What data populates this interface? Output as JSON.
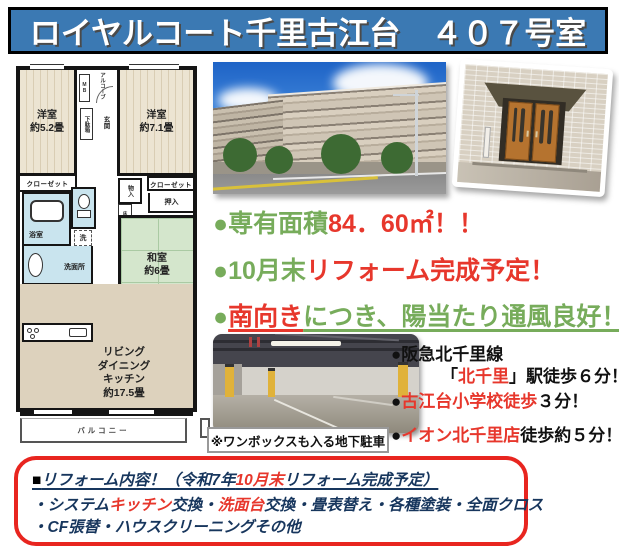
{
  "banner": {
    "title": "ロイヤルコート千里古江台　４０７号室"
  },
  "colors": {
    "banner_blue": "#3b79b3",
    "text_green": "#77ac5b",
    "text_red": "#e7372c",
    "text_navy": "#17365d",
    "reform_border_red": "#e8251f"
  },
  "floorplan": {
    "bedroom1_line1": "洋室",
    "bedroom1_line2": "約5.2畳",
    "bedroom2_line1": "洋室",
    "bedroom2_line2": "約7.1畳",
    "tatami_line1": "和室",
    "tatami_line2": "約6畳",
    "ldk_line1": "リビング",
    "ldk_line2": "ダイニング",
    "ldk_line3": "キッチン",
    "ldk_line4": "約17.5畳",
    "closet_left": "クローゼット",
    "closet_right": "クローゼット",
    "bath": "浴室",
    "washroom": "洗面所",
    "laundry": "洗",
    "fridge": "冷",
    "storage": "物入",
    "oshiire": "押入",
    "tokonoma": "床の間",
    "entrance": "玄関",
    "shoebox": "下駄箱",
    "alcove": "アルコーブ",
    "meter_box": "MB",
    "balcony": "バルコニー"
  },
  "features": {
    "area_green": "●専有面積",
    "area_red": "84．60㎡！！",
    "date_green": "●10月末",
    "date_red": "リフォーム完成予定！",
    "south_bullet": "●",
    "south_red": "南向き",
    "south_green": "につき、陽当たり通風良好！"
  },
  "access": {
    "rail_line": "●阪急北千里線",
    "station_pre": "「",
    "station_red": "北千里",
    "station_post": "」駅徒歩６分！",
    "school_bullet": "●",
    "school_red": "古江台小学校徒歩",
    "school_post": "３分！",
    "shop_bullet": "●",
    "shop_red": "イオン北千里店",
    "shop_post": "徒歩約５分！"
  },
  "garage_caption": "※ワンボックスも入る地下駐車",
  "reform": {
    "square": "■",
    "title_pre": "リフォーム内容！（令和7年",
    "title_red": "10月末",
    "title_post": "リフォーム完成予定）",
    "item1_pre": "・システム",
    "item1_red1": "キッチン",
    "item1_mid": "交換・",
    "item1_red2": "洗面台",
    "item1_post": "交換・畳表替え・各種塗装・全面クロス",
    "item2": "・CF張替・ハウスクリーニングその他"
  }
}
